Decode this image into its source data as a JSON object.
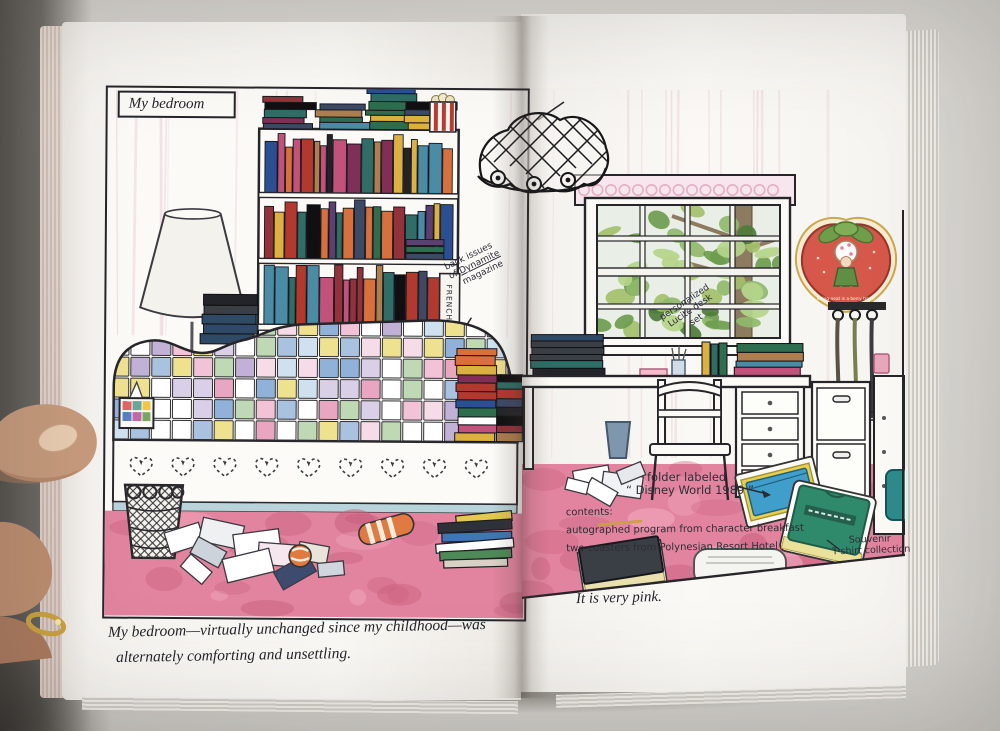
{
  "photo": {
    "background": "#d7d5d0",
    "carpet_pink": "#e2849f",
    "strawberry_red": "#d5584a",
    "quilt_palette": [
      "#ffffff",
      "#f2c2d6",
      "#a9c2e0",
      "#efe28f",
      "#bfd9b4",
      "#c2b1d6",
      "#e8a6c0"
    ]
  },
  "left_page": {
    "panel_label": "My bedroom",
    "shelf_note": {
      "line1": "back issues",
      "line2_prefix": "of ",
      "line2_word": "Dynamite",
      "line3": "magazine"
    },
    "binder_label": "FRENCH A",
    "caption": {
      "line1": "My bedroom—virtually unchanged since my childhood—was",
      "line2": "alternately comforting and unsettling."
    }
  },
  "right_page": {
    "desk_note": {
      "line1": "personalized",
      "line2": "Lucite desk",
      "line3": "set"
    },
    "strawberry_note": "Being neat is a berry treat!",
    "vote_label": "VOTE",
    "folder_note": {
      "line1": "folder labeled",
      "line2": "“ Disney World 1989 ”"
    },
    "contents_note": {
      "line1": "contents:",
      "line2": "autographed program from character breakfast",
      "line3": "two coasters from Polynesian Resort Hotel"
    },
    "tshirt_note": {
      "line1": "Souvenir",
      "line2": "T-shirt collection"
    },
    "caption": "It is very pink."
  }
}
